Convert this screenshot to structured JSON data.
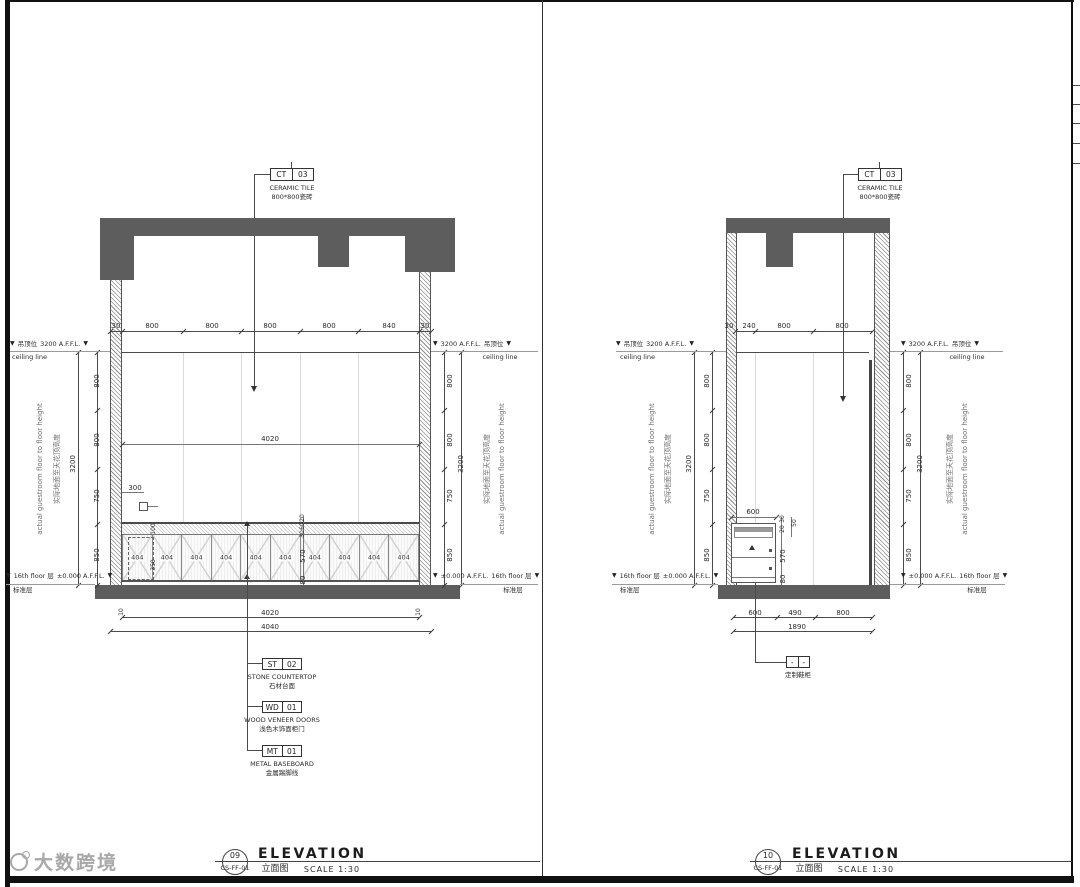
{
  "icons": {
    "level_marker": "▼"
  },
  "watermark": {
    "brand": "大数跨境"
  },
  "labels": {
    "ceiling_cn": "吊顶位",
    "ceiling_level": "3200 A.F.F.L.",
    "ceiling_line": "ceiling line",
    "floor_en": "16th floor 层",
    "floor_level": "±0.000 A.F.F.L.",
    "floor_cn": "标准层",
    "height_en": "actual guestroom floor to floor height",
    "height_cn": "实际地面至天花顶高度"
  },
  "left": {
    "callout": {
      "code": "CT",
      "num": "03",
      "name": "CERAMIC TILE",
      "cn": "800*800瓷砖"
    },
    "dims_top": [
      "30",
      "800",
      "800",
      "800",
      "800",
      "840",
      "30"
    ],
    "dims_side": [
      "800",
      "800",
      "750",
      "850"
    ],
    "overall": "3200",
    "interior_width": "4020",
    "socket_dim": "300",
    "niche_dims": [
      "100",
      "350"
    ],
    "counter_chain": [
      "20",
      "60",
      "30",
      "570",
      "80"
    ],
    "doors": [
      "404",
      "404",
      "404",
      "404",
      "404",
      "404",
      "404",
      "404",
      "404",
      "404"
    ],
    "bottom": {
      "edge": "10",
      "inner": "4020",
      "overall": "4040"
    },
    "tags": [
      {
        "code": "ST",
        "num": "02",
        "name": "STONE COUNTERTOP",
        "cn": "石材台面"
      },
      {
        "code": "WD",
        "num": "01",
        "name": "WOOD VENEER DOORS",
        "cn": "浅色木饰面柜门"
      },
      {
        "code": "MT",
        "num": "01",
        "name": "METAL BASEBOARD",
        "cn": "金属踢脚线"
      }
    ],
    "title": {
      "num": "09",
      "ref": "CS-FF-01",
      "name": "ELEVATION",
      "cn": "立面图",
      "scale": "SCALE 1:30"
    }
  },
  "right": {
    "callout": {
      "code": "CT",
      "num": "03",
      "name": "CERAMIC TILE",
      "cn": "800*800瓷砖"
    },
    "dims_top": [
      "30",
      "240",
      "800",
      "800"
    ],
    "dims_side": [
      "800",
      "800",
      "750",
      "850"
    ],
    "overall": "3200",
    "cabinet_width": "600",
    "cabinet_chain": [
      "30",
      "20",
      "50",
      "570",
      "80"
    ],
    "bottom": {
      "segments": [
        "600",
        "490",
        "800"
      ],
      "overall": "1890"
    },
    "tag": {
      "code": "-",
      "num": "-",
      "cn": "定制鞋柜"
    },
    "title": {
      "num": "10",
      "ref": "CS-FF-01",
      "name": "ELEVATION",
      "cn": "立面图",
      "scale": "SCALE 1:30"
    }
  }
}
